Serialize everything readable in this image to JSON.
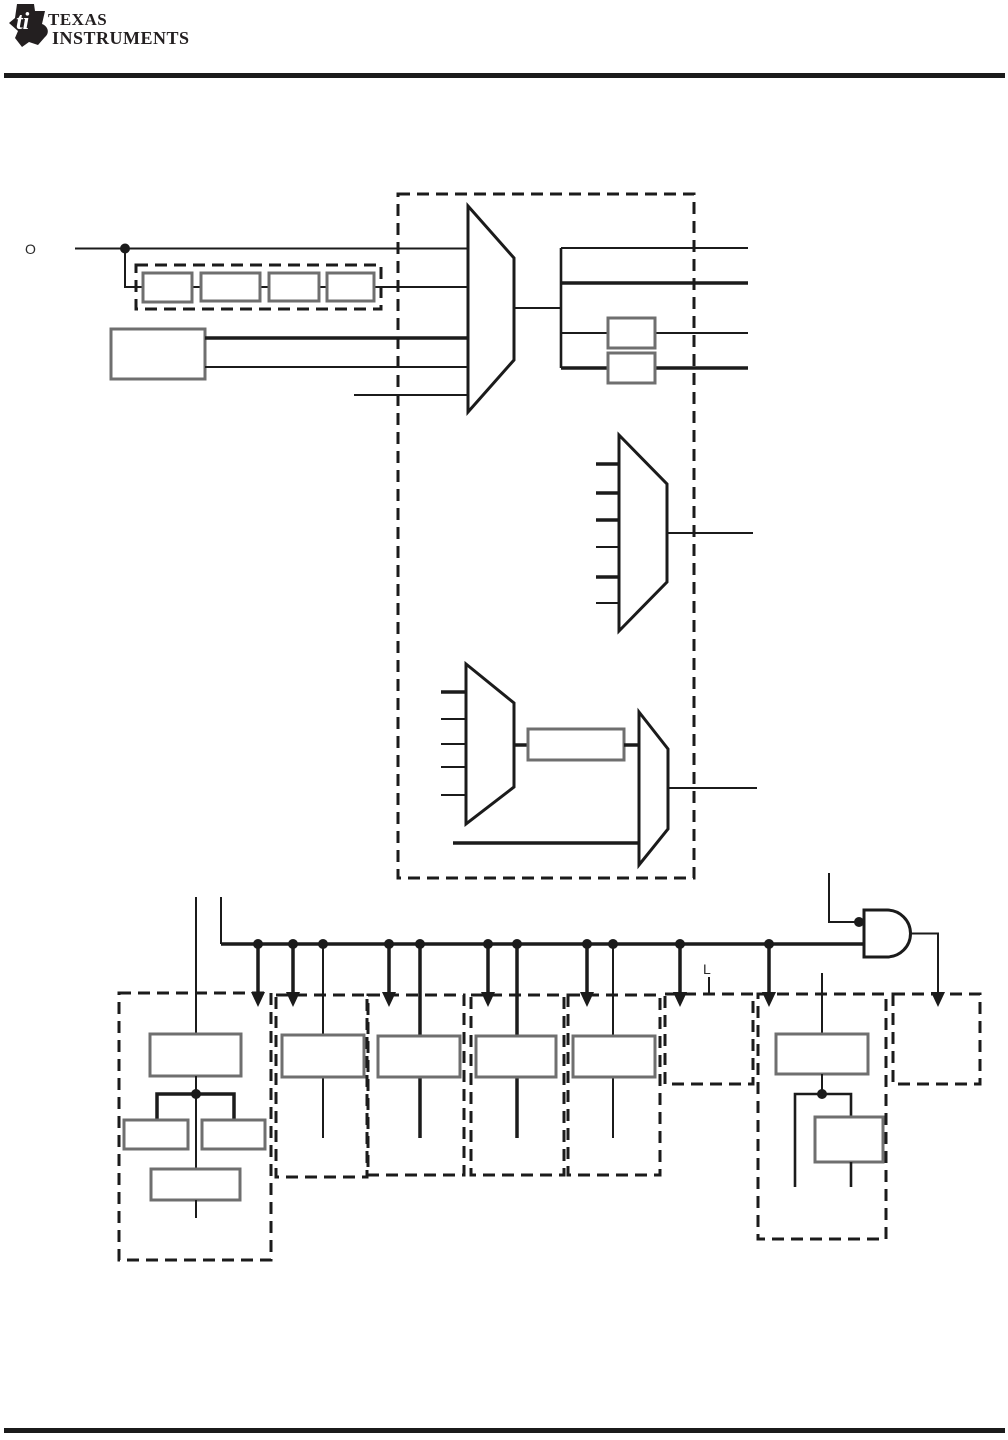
{
  "page": {
    "background": "#ffffff",
    "ink_color": "#1b1b1b",
    "box_stroke_color": "#6f6f6f"
  },
  "header": {
    "logo": {
      "bug_text": "ti",
      "line1": "TEXAS",
      "line2": "INSTRUMENTS"
    }
  },
  "figure": {
    "type": "block-diagram",
    "labels": {
      "osc_input": "O",
      "module_input": "L"
    },
    "components": {
      "divider_chain_stages": 4,
      "mux_count": 4,
      "mux_input_counts": [
        5,
        6,
        5,
        2
      ],
      "post_mux_divider_boxes": 2,
      "clock_gate": "2-input AND gate with dotted input",
      "dashed_peripheral_modules": 8,
      "bus_tap_dots": 11,
      "bus_arrow_taps": 7,
      "gated_clock_arrows": 1
    }
  }
}
